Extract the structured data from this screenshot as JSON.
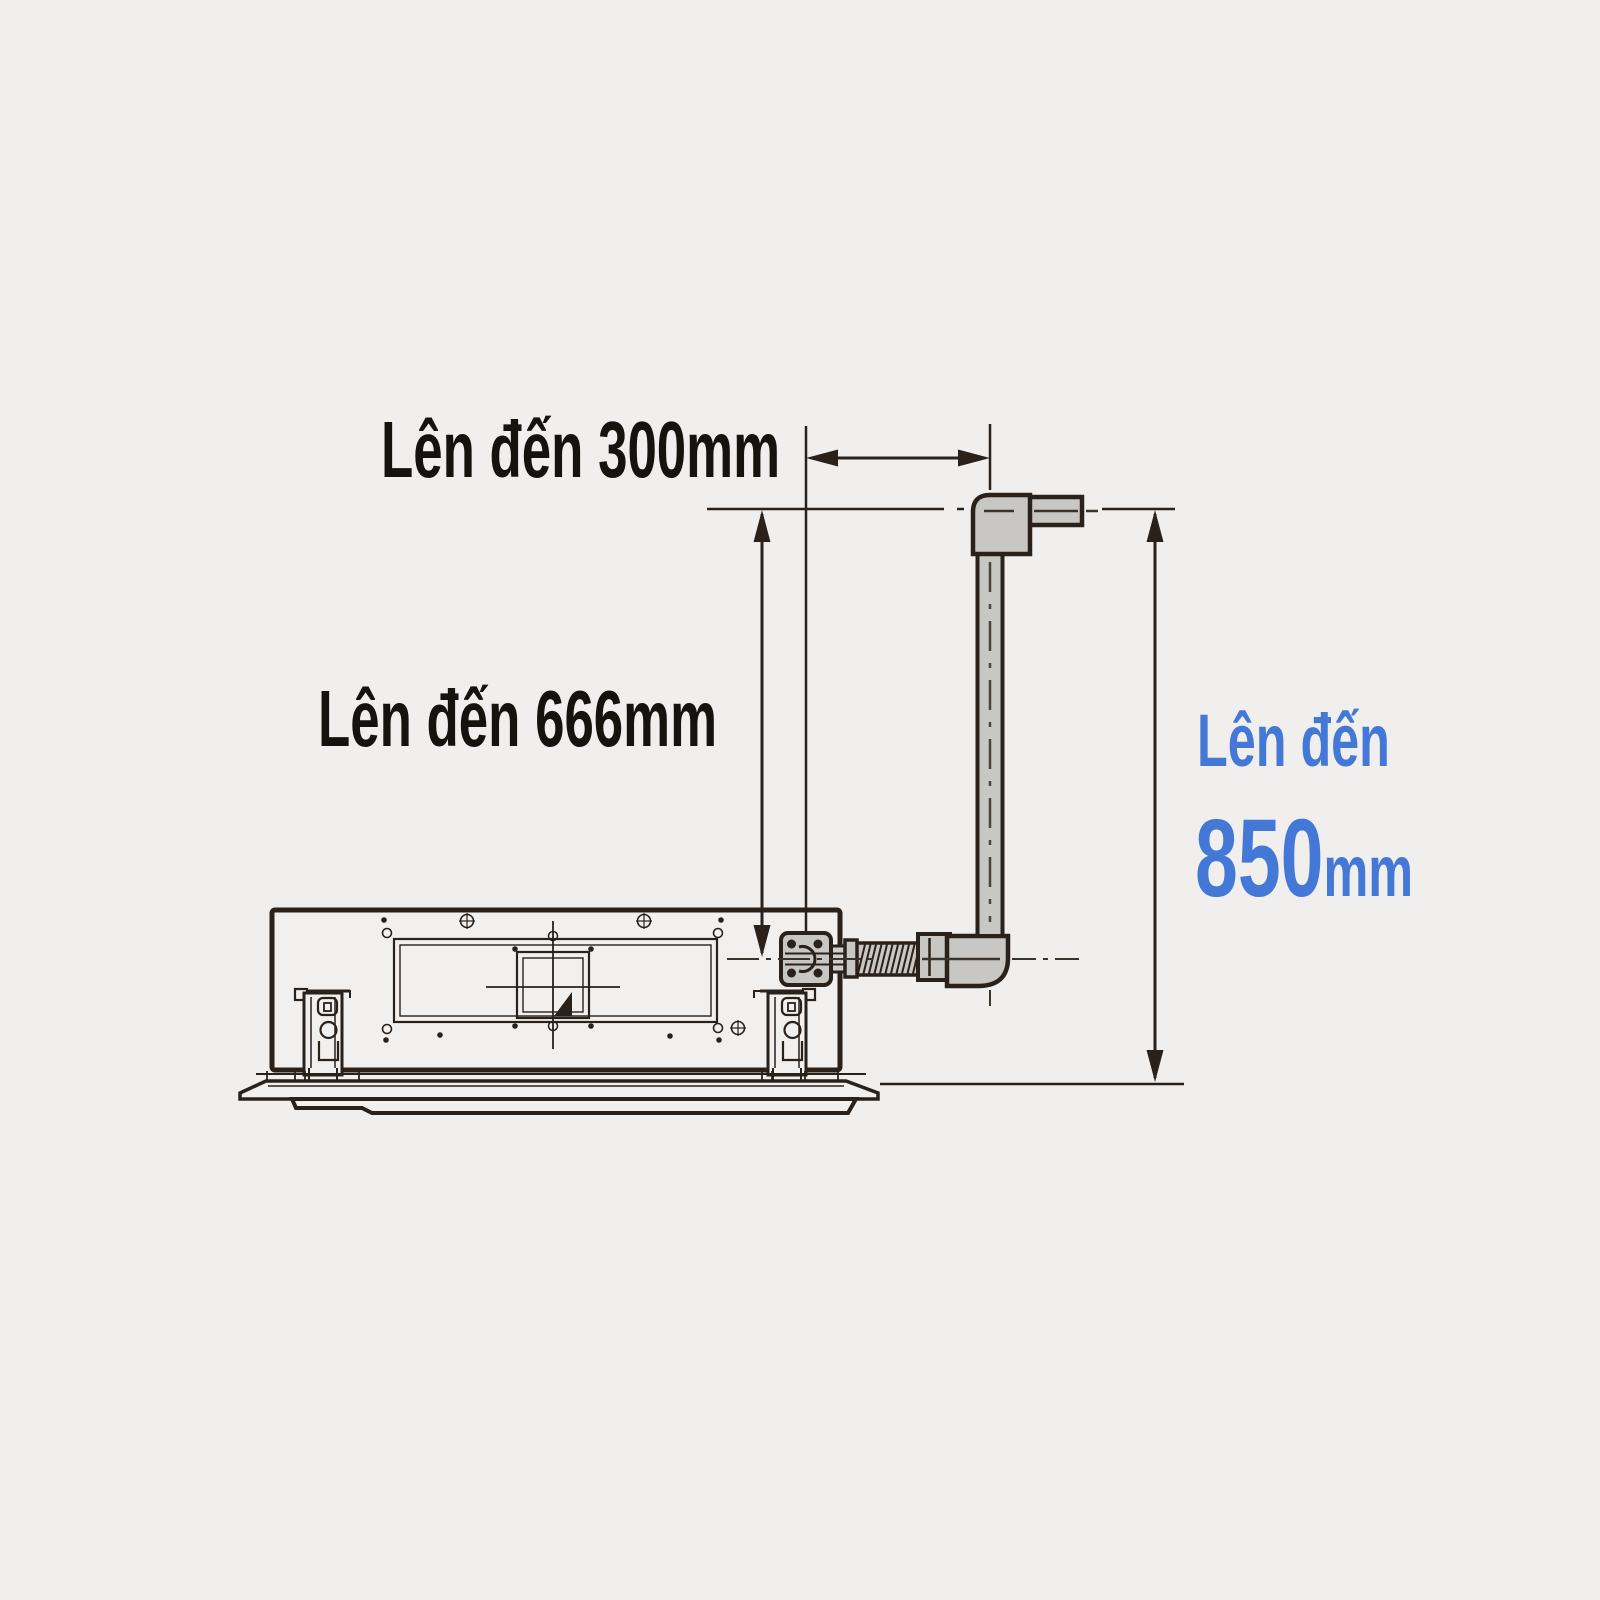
{
  "diagram": {
    "type": "technical-dimension-drawing",
    "subject_view": "indoor-unit-side-view-with-drain-riser",
    "labels": {
      "dim_300": "Lên đến 300mm",
      "dim_666": "Lên đến 666mm",
      "dim_850_prefix": "Lên đến",
      "dim_850_value": "850",
      "dim_850_unit": "mm"
    },
    "dimensions": [
      {
        "value": 300,
        "unit": "mm",
        "text": "Lên đến 300mm",
        "orientation": "horizontal"
      },
      {
        "value": 666,
        "unit": "mm",
        "text": "Lên đến 666mm",
        "orientation": "vertical"
      },
      {
        "value": 850,
        "unit": "mm",
        "text": "Lên đến 850mm",
        "orientation": "vertical",
        "accent": true
      }
    ],
    "colors": {
      "background": "#f0efed",
      "line": "#2a211b",
      "centerline": "#3a332c",
      "pipe_fill": "#c9c7c4",
      "text": "#16120e",
      "accent_blue": "#4478d6"
    }
  }
}
